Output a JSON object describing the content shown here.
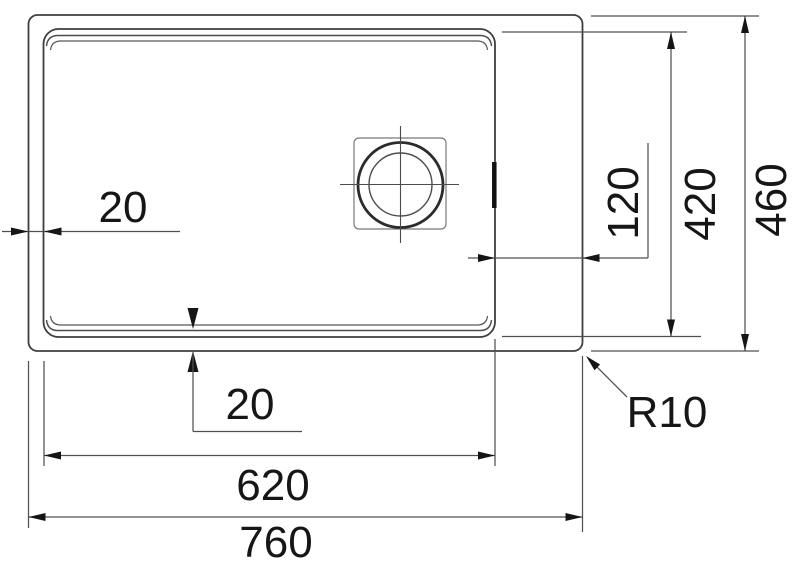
{
  "drawing": {
    "kind": "sink-plan-dimension-drawing",
    "colors": {
      "background": "#ffffff",
      "object_line": "#3e3e3e",
      "dimension_line": "#505050",
      "text": "#161616"
    },
    "dimensions": {
      "overall_width": {
        "label": "760"
      },
      "bowl_width": {
        "label": "620"
      },
      "overall_depth": {
        "label": "460"
      },
      "bowl_depth": {
        "label": "420"
      },
      "rim_offset_left": {
        "label": "20"
      },
      "rim_offset_bottom": {
        "label": "20"
      },
      "bowl_right_offset": {
        "label": "120"
      },
      "corner_radius": {
        "label": "R10"
      }
    }
  }
}
